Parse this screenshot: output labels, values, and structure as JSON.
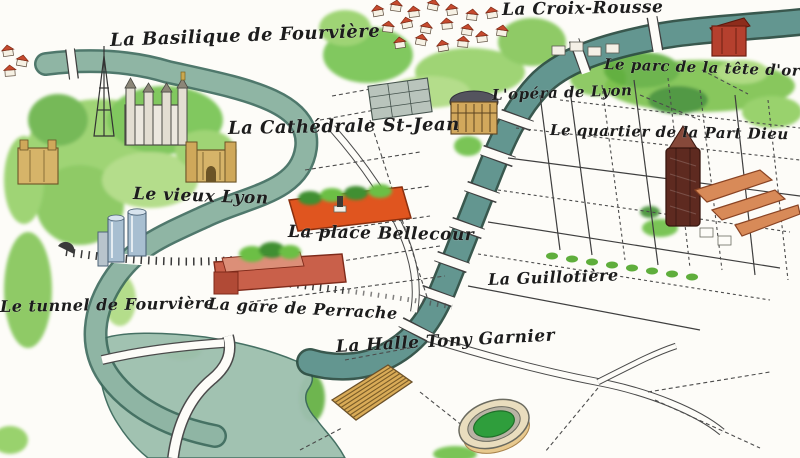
{
  "map": {
    "labels": [
      {
        "id": "croix-rousse",
        "text": "La Croix-Rousse"
      },
      {
        "id": "basilique-fourviere",
        "text": "La Basilique de Fourvière"
      },
      {
        "id": "parc-tete-dor",
        "text": "Le parc de la tête d'or"
      },
      {
        "id": "opera-lyon",
        "text": "L'opéra de Lyon"
      },
      {
        "id": "cathedrale-st-jean",
        "text": "La Cathédrale St-Jean"
      },
      {
        "id": "quartier-part-dieu",
        "text": "Le quartier de la Part Dieu"
      },
      {
        "id": "vieux-lyon",
        "text": "Le vieux Lyon"
      },
      {
        "id": "place-bellecour",
        "text": "La place Bellecour"
      },
      {
        "id": "guillotiere",
        "text": "La Guillotière"
      },
      {
        "id": "tunnel-fourviere",
        "text": "Le tunnel de Fourvière"
      },
      {
        "id": "gare-perrache",
        "text": "La gare de Perrache"
      },
      {
        "id": "halle-tony-garnier",
        "text": "La Halle Tony Garnier"
      }
    ],
    "palette": {
      "paper": "#fdfcf8",
      "ink": "#1c1c1c",
      "saone_river": "#8fb5a4",
      "rhone_river": "#639690",
      "river_outline": "#35594f",
      "foliage": "#6cbf45",
      "foliage_dark": "#3f8f33",
      "red_roofs": "#c64a2e",
      "bellecour_orange": "#e0551f",
      "perrache_red": "#c9604a",
      "part_dieu_tower": "#5e2a20",
      "mall_orange": "#d88a58",
      "landmark_gold": "#d6b469",
      "halle_gold": "#d9ab57",
      "stadium_green": "#2f9e3c"
    }
  }
}
